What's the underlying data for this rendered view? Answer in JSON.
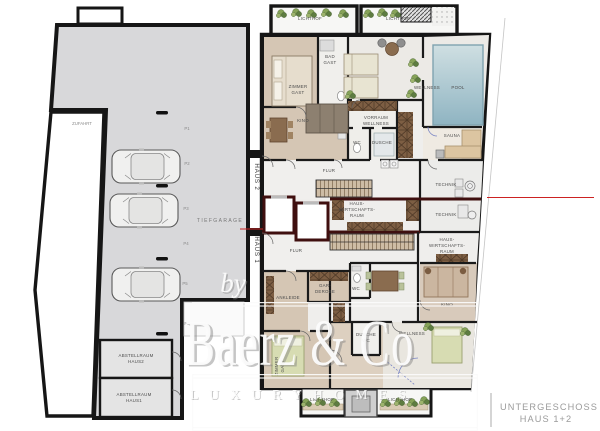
{
  "title_block": {
    "line1": "UNTERGESCHOSS",
    "line2": "HAUS 1+2"
  },
  "watermark": {
    "by": "by",
    "brand": "Baerz & Co",
    "tagline": "L U X U R Y   H O M E S"
  },
  "garage": {
    "label": "TIEFGARAGE",
    "ramp_label": "ZUFAHRT",
    "house2": "HAUS 2",
    "house1": "HAUS 1",
    "spots": [
      "P1",
      "P2",
      "P3",
      "P4",
      "P5",
      "P6"
    ],
    "storage2": [
      "ABSTELLRAUM",
      "HAUS2"
    ],
    "storage1": [
      "ABSTELLRAUM",
      "HAUS1"
    ]
  },
  "haus2": {
    "lichthof_left": "LICHTHOF",
    "lichthof_right": "LICHTHOF",
    "zimmer_gast": [
      "ZIMMER",
      "GAST"
    ],
    "bad_gast": [
      "BAD",
      "GAST"
    ],
    "kino": "KINO",
    "vorraum": [
      "VORRAUM",
      "WELLNESS"
    ],
    "wc": "WC",
    "dusche": "DUSCHE",
    "wellness": "WELLNESS",
    "pool": "POOL",
    "sauna": "SAUNA",
    "flur": "FLUR",
    "technik": "TECHNIK",
    "hwr": [
      "HAUS-",
      "WIRTSCHAFTS-",
      "RAUM"
    ]
  },
  "haus1": {
    "flur": "FLUR",
    "technik": "TECHNIK",
    "hwr": [
      "HAUS-",
      "WIRTSCHAFTS-",
      "RAUM"
    ],
    "ankleide": "ANKLEIDE",
    "garderobe": [
      "GAR-",
      "DEROBE"
    ],
    "wc": "WC",
    "dusche": [
      "DUSCHE",
      "WC"
    ],
    "zimmer_gast": [
      "ZIMMER",
      "GAST"
    ],
    "kino": "KINO",
    "wellness": "WELLNESS",
    "lichthof_left": "LICHTHOF",
    "lichthof_right": "LICHTHOF"
  },
  "colors": {
    "wall": "#1a1a1a",
    "fire_wall": "#3f0f0f",
    "section_line_red": "#cc2222",
    "garage_floor": "#d8d8da",
    "room_beige": "#d5c6b4",
    "pool_blue": "#9cbcc8",
    "bed_green": "#d7dcb2",
    "cabinet_brown": "#7d5e43",
    "sauna_wood": "#dcc5a1",
    "plant_green": "#7d9b5e",
    "watermark_white": "#fcfcfc",
    "title_gray": "#9b9b9b"
  }
}
